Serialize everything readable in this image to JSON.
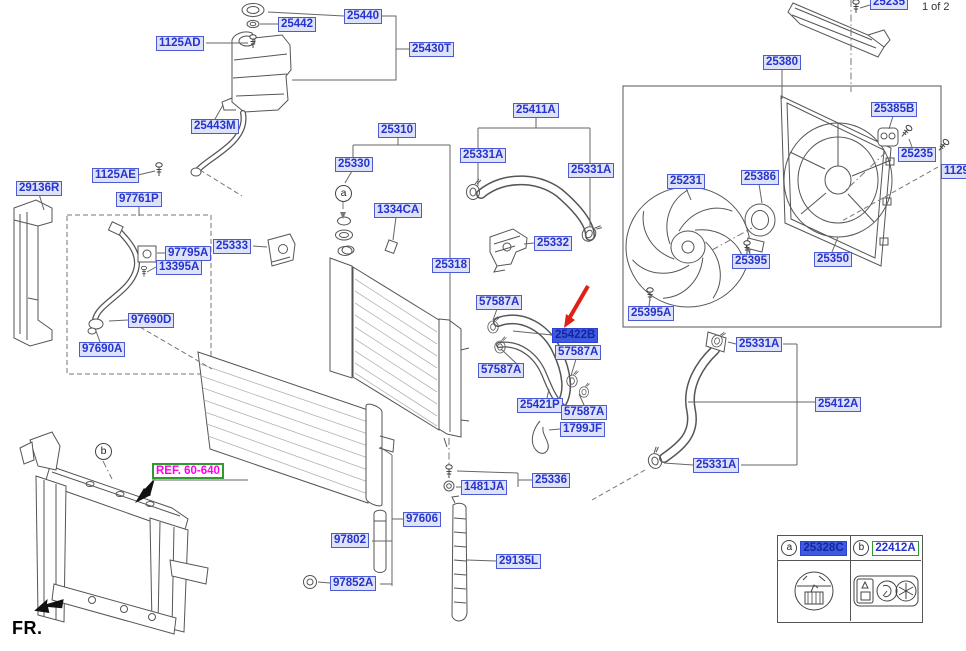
{
  "page": {
    "sheet_indicator": "1 of 2",
    "fr_label": "FR."
  },
  "colors": {
    "label_text": "#2633cc",
    "label_bg": "#dde2f8",
    "label_border": "#4c5ad4",
    "selected_bg": "#3d5be0",
    "selected_text": "#16249e",
    "green_border": "#2f9b2f",
    "ref_text": "#ff00e8",
    "arrow_red": "#df2015"
  },
  "labels": [
    {
      "text": "1125AD",
      "x": 156,
      "y": 36
    },
    {
      "text": "25442",
      "x": 278,
      "y": 17
    },
    {
      "text": "25440",
      "x": 344,
      "y": 9
    },
    {
      "text": "25430T",
      "x": 409,
      "y": 42
    },
    {
      "text": "25443M",
      "x": 191,
      "y": 119
    },
    {
      "text": "25310",
      "x": 378,
      "y": 123
    },
    {
      "text": "29136R",
      "x": 16,
      "y": 181
    },
    {
      "text": "1125AE",
      "x": 92,
      "y": 168
    },
    {
      "text": "97761P",
      "x": 116,
      "y": 192
    },
    {
      "text": "97795A",
      "x": 165,
      "y": 246
    },
    {
      "text": "13395A",
      "x": 156,
      "y": 260
    },
    {
      "text": "25333",
      "x": 213,
      "y": 239
    },
    {
      "text": "97690D",
      "x": 128,
      "y": 313
    },
    {
      "text": "97690A",
      "x": 79,
      "y": 342
    },
    {
      "text": "25330",
      "x": 335,
      "y": 157
    },
    {
      "text": "1334CA",
      "x": 374,
      "y": 203
    },
    {
      "text": "25331A",
      "x": 460,
      "y": 148
    },
    {
      "text": "25411A",
      "x": 513,
      "y": 103
    },
    {
      "text": "25331A",
      "x": 568,
      "y": 163
    },
    {
      "text": "25332",
      "x": 534,
      "y": 236
    },
    {
      "text": "25318",
      "x": 432,
      "y": 258
    },
    {
      "text": "57587A",
      "x": 476,
      "y": 295
    },
    {
      "text": "25422B",
      "x": 552,
      "y": 328,
      "variant": "selected"
    },
    {
      "text": "57587A",
      "x": 555,
      "y": 345
    },
    {
      "text": "57587A",
      "x": 478,
      "y": 363
    },
    {
      "text": "25421P",
      "x": 517,
      "y": 398
    },
    {
      "text": "57587A",
      "x": 561,
      "y": 405
    },
    {
      "text": "1799JF",
      "x": 560,
      "y": 422
    },
    {
      "text": "1481JA",
      "x": 461,
      "y": 480
    },
    {
      "text": "25336",
      "x": 532,
      "y": 473
    },
    {
      "text": "97606",
      "x": 403,
      "y": 512
    },
    {
      "text": "97802",
      "x": 331,
      "y": 533
    },
    {
      "text": "97852A",
      "x": 330,
      "y": 576
    },
    {
      "text": "29135L",
      "x": 496,
      "y": 554
    },
    {
      "text": "25380",
      "x": 763,
      "y": 55
    },
    {
      "text": "25385B",
      "x": 871,
      "y": 102
    },
    {
      "text": "25235",
      "x": 898,
      "y": 147
    },
    {
      "text": "1129",
      "x": 941,
      "y": 164
    },
    {
      "text": "25231",
      "x": 667,
      "y": 174
    },
    {
      "text": "25386",
      "x": 741,
      "y": 170
    },
    {
      "text": "25395",
      "x": 732,
      "y": 254
    },
    {
      "text": "25350",
      "x": 814,
      "y": 252
    },
    {
      "text": "25395A",
      "x": 628,
      "y": 306
    },
    {
      "text": "25331A",
      "x": 736,
      "y": 337
    },
    {
      "text": "25412A",
      "x": 815,
      "y": 397
    },
    {
      "text": "25331A",
      "x": 693,
      "y": 458
    },
    {
      "text": "25235",
      "x": 870,
      "y": -5
    },
    {
      "text": "REF. 60-640",
      "x": 152,
      "y": 463,
      "variant": "ref"
    }
  ],
  "markers": [
    {
      "letter": "a",
      "x": 343,
      "y": 193
    },
    {
      "letter": "b",
      "x": 103,
      "y": 451
    }
  ],
  "legend": {
    "cells": [
      {
        "marker": "a",
        "part": "25328C",
        "variant": "selected"
      },
      {
        "marker": "b",
        "part": "22412A",
        "variant": "green"
      }
    ]
  }
}
